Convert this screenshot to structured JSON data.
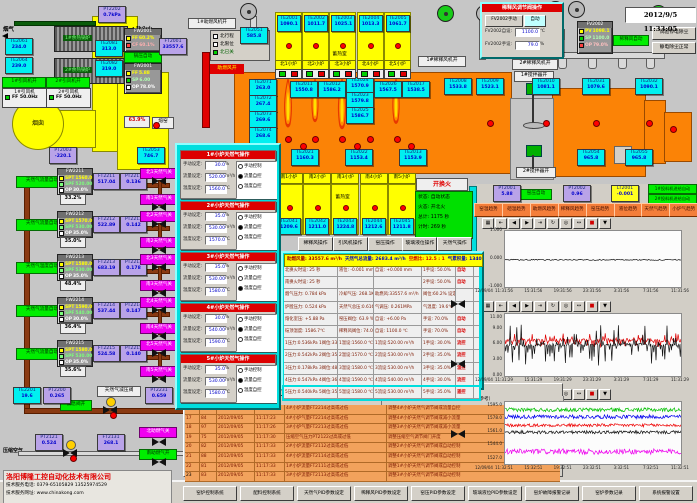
{
  "datetime": "2012/9/5 11:33:05",
  "colors": {
    "furnace_orange": "#fb8306",
    "accent_yellow": "#ffff00",
    "tag_cyan": "#00f0f0",
    "tag_lavender": "#b9a3e8",
    "status_green": "#00ee00",
    "valve_magenta": "#f000f0",
    "alarm_orange": "#f2a25c",
    "popup_cyan": "#00dede"
  },
  "top_left": {
    "flue_gas": "烟气",
    "soft_water": "软化水",
    "boilers": [
      "1#余热锅炉",
      "2#余热锅炉"
    ],
    "fan_status": [
      "1#引风机开",
      "2#引风机开"
    ],
    "fans": [
      {
        "name": "1#引风机",
        "ff": "FF 50.0Hz"
      },
      {
        "name": "2#引风机",
        "ff": "FF 50.0Hz"
      }
    ],
    "chimney": "烟囱",
    "boiler_auto": "锅压自动",
    "fw2001_top": {
      "tag": "FW2001",
      "rows": [
        [
          "FF",
          "60.2%"
        ],
        [
          "CF",
          "60.1%"
        ]
      ]
    },
    "fw2001_mid": {
      "tag": "FW2001",
      "rows": [
        [
          "FF",
          "5.88"
        ],
        [
          "SP",
          "6.00"
        ],
        [
          "OP",
          "78.0%"
        ]
      ]
    },
    "valve_pct": "63.9%",
    "kiln": "熔窑",
    "aux_air_open": "助燃风开",
    "fan1_open": "1#助燃风机开",
    "limit_box": [
      "北行程",
      "北限位",
      "北已关"
    ]
  },
  "instruments": [
    {
      "t": "PT2202",
      "v": "0.7kPa"
    },
    {
      "t": "TE2061",
      "v": "234.0"
    },
    {
      "t": "TE2064",
      "v": "239.0"
    },
    {
      "t": "TE2081",
      "v": "313.0"
    },
    {
      "t": "TE2082",
      "v": "319.0"
    },
    {
      "t": "PT2003",
      "v": "-220.1"
    },
    {
      "t": "FT2001",
      "v": "33557.6"
    },
    {
      "t": "TE2053",
      "v": "746.7"
    },
    {
      "t": "TE2051",
      "v": "585.8"
    },
    {
      "t": "TE2071",
      "v": "263.0"
    },
    {
      "t": "TE2072",
      "v": "267.4"
    },
    {
      "t": "TE2073",
      "v": "269.6"
    },
    {
      "t": "TE2074",
      "v": "268.6"
    },
    {
      "t": "TE2011",
      "v": "1550.8"
    },
    {
      "t": "TE2012",
      "v": "1586.2"
    },
    {
      "t": "TE2024",
      "v": "1570.9"
    },
    {
      "t": "TE2023",
      "v": "1579.8"
    },
    {
      "t": "TE2025",
      "v": "1586.7"
    },
    {
      "t": "TE2026",
      "v": "1567.5"
    },
    {
      "t": "TE2017",
      "v": "1538.5"
    },
    {
      "t": "TE2008",
      "v": "1533.8"
    },
    {
      "t": "TE2009",
      "v": "1523.1"
    },
    {
      "t": "TE2010",
      "v": "1081.1"
    },
    {
      "t": "TE2031",
      "v": "1079.6"
    },
    {
      "t": "TE2032",
      "v": "1090.1"
    },
    {
      "t": "TE2021",
      "v": "1160.3"
    },
    {
      "t": "TE2022",
      "v": "1153.4"
    },
    {
      "t": "TE2013",
      "v": "1153.9"
    },
    {
      "t": "TE2054",
      "v": "965.8"
    },
    {
      "t": "TE2055",
      "v": "965.8"
    },
    {
      "t": "TE2201",
      "v": "19.6"
    },
    {
      "t": "PT2200",
      "v": "0.265"
    },
    {
      "t": "PT2231",
      "v": "0.659"
    },
    {
      "t": "PT2121",
      "v": "0.524"
    },
    {
      "t": "FT2131",
      "v": "268.1"
    },
    {
      "t": "FT2002",
      "v": "6331.6"
    },
    {
      "t": "PT2001",
      "v": "5.88"
    },
    {
      "t": "PT2002",
      "v": "0.96"
    },
    {
      "t": "LT2001",
      "v": "-0.001"
    }
  ],
  "chambers_north": {
    "label": "蓄热室",
    "items": [
      {
        "tag": "TE2001",
        "val": "1090.1"
      },
      {
        "tag": "TE2002",
        "val": "1011.7"
      },
      {
        "tag": "TE2003",
        "val": "1025.1"
      },
      {
        "tag": "TE2004",
        "val": "1013.3"
      },
      {
        "tag": "TE2005",
        "val": "1061.7"
      }
    ],
    "furnaces": [
      "北1小炉",
      "北2小炉",
      "北3小炉",
      "北4小炉",
      "北5小炉"
    ]
  },
  "chambers_south": {
    "label": "蓄热室",
    "items": [
      {
        "tag": "TE2041",
        "val": "1209.6"
      },
      {
        "tag": "TE2042",
        "val": "1211.0"
      },
      {
        "tag": "TE2043",
        "val": "1224.8"
      },
      {
        "tag": "TE2044",
        "val": "1212.6"
      },
      {
        "tag": "TE2045",
        "val": "1211.8"
      }
    ],
    "furnaces": [
      "南1小炉",
      "南2小炉",
      "南3小炉",
      "南4小炉",
      "南5小炉"
    ]
  },
  "dilution_popup": {
    "title": "稀释风调节阀操作",
    "manual_btn": "FV2002手动",
    "auto_btn": "自动",
    "rows": [
      [
        "FV2002自设:",
        "1100.0",
        "℃"
      ],
      [
        "FV2002手设:",
        "79.0",
        "%"
      ]
    ]
  },
  "fv2002": {
    "tag": "FV2002",
    "rows": [
      [
        "PV",
        "1098.1"
      ],
      [
        "SP",
        "1100.0"
      ],
      [
        "OP",
        "79.0%"
      ]
    ]
  },
  "dilution_auto": "稀释风自动",
  "right_btns": [
    "试验停电除尘",
    "静电除尘正常"
  ],
  "labels_misc": {
    "valve74": "74.0%",
    "dilution_fan1": "1#稀释风机开",
    "dilution_fan2": "2#稀释风机开",
    "mixer1": "1#搅拌器开",
    "mixer2": "2#搅拌器开"
  },
  "right_tags": {
    "kiln_pressure_auto": "窑压自动",
    "feeders": [
      "1#投料机进给自动",
      "2#投料机进给自动"
    ]
  },
  "gas_lines": {
    "row_labels": [
      "SPT",
      "SPF",
      "OP"
    ],
    "auto_labels": [
      "天然气流量自动",
      "天然气流量自动",
      "天然气温度自动",
      "天然气流量自动",
      "天然气流量自动"
    ],
    "lines": [
      {
        "ctrl": "FW2211",
        "spt": "1560.0",
        "spf": "520.00",
        "op": "30.0%",
        "ft": "FT2211",
        "ftv": "517.04",
        "pt": "PT2211",
        "ptv": "0.136",
        "valve": "33.2%",
        "north": "北1天然气关",
        "south": "南1天然气关"
      },
      {
        "ctrl": "FW2212",
        "spt": "1570.0",
        "spf": "530.00",
        "op": "35.0%",
        "ft": "FT2212",
        "ftv": "522.89",
        "pt": "PT2212",
        "ptv": "0.142",
        "valve": "35.0%",
        "north": "北2天然气关",
        "south": "南2天然气关"
      },
      {
        "ctrl": "FW2213",
        "spt": "1580.0",
        "spf": "530.00",
        "op": "35.0%",
        "ft": "FT2213",
        "ftv": "683.19",
        "pt": "PT2213",
        "ptv": "0.178",
        "valve": "48.4%",
        "north": "北3天然气关",
        "south": "南3天然气关"
      },
      {
        "ctrl": "FW2214",
        "spt": "1590.0",
        "spf": "540.00",
        "op": "30.0%",
        "ft": "FT2214",
        "ftv": "537.44",
        "pt": "PT2214",
        "ptv": "0.147",
        "valve": "36.4%",
        "north": "北4天然气关",
        "south": "南4天然气关"
      },
      {
        "ctrl": "FW2215",
        "spt": "1580.0",
        "spf": "530.00",
        "op": "35.0%",
        "ft": "FT2215",
        "ftv": "524.58",
        "pt": "PT2215",
        "ptv": "0.140",
        "valve": "35.6%",
        "north": "北5天然气关",
        "south": "南5天然气关"
      }
    ]
  },
  "reduce_line": {
    "label": "天然气减压阀",
    "emergency": "紧急阀开"
  },
  "air_line": {
    "label": "压缩空气",
    "north": "北助燃气关",
    "south": "南助燃气开"
  },
  "company": {
    "name": "洛阳博隆工控自动化技术有限公司",
    "tel": "技术服务电话: 0379-65105829  13525974529",
    "web": "技术服务网址: www.chinakong.com"
  },
  "furnace_popup": {
    "field_labels": [
      "手动设定:",
      "流量设定:",
      "温度设定:"
    ],
    "units": [
      "%",
      "m³/h",
      "℃"
    ],
    "radio_labels": [
      "手动控制",
      "流量自控",
      "温度自控"
    ],
    "panels": [
      {
        "title": "1#小炉天然气操作",
        "manual": "30.0",
        "flow": "520.00",
        "temp": "1560.0",
        "mode": 1
      },
      {
        "title": "2#小炉天然气操作",
        "manual": "35.0",
        "flow": "530.00",
        "temp": "1570.0",
        "mode": 1
      },
      {
        "title": "3#小炉天然气操作",
        "manual": "35.0",
        "flow": "530.00",
        "temp": "1580.0",
        "mode": 2
      },
      {
        "title": "4#小炉天然气操作",
        "manual": "30.0",
        "flow": "540.00",
        "temp": "1590.0",
        "mode": 1
      },
      {
        "title": "5#小炉天然气操作",
        "manual": "35.0",
        "flow": "530.00",
        "temp": "1580.0",
        "mode": 1
      }
    ]
  },
  "center": {
    "change_fire_btn": "开换火",
    "status_box": [
      "状态: 自动状态",
      "火态: 开北火",
      "总计: 1175 秒",
      "计时: 269 秒"
    ],
    "ops_buttons": [
      "稀释风操作",
      "引风机操作",
      "窑压操作",
      "玻璃液位操作",
      "天然气操作"
    ],
    "summary": [
      "助燃风量: 33557.6 m³/h",
      "天然气总流量: 2683.4 m³/h",
      "空燃比: 12.5 : 1",
      "气累积量: 134057.7m³"
    ],
    "rows": [
      [
        "北换火时设: 25 秒",
        "液位: -0.001 mm",
        "自设: +0.000 mm",
        "1手设: 50.0%",
        "自动"
      ],
      [
        "南换火时设: 25 秒",
        "",
        "",
        "2手设: 50.0%",
        "自动"
      ],
      [
        "烟气压力: 0.784 kPa",
        "冷却气压: 268.1KPa",
        "助燃风:33557.6 m³/h",
        "阀位:60.2% 设定:60.0%",
        ""
      ],
      [
        "炉膛压力: 0.524 kPa",
        "天然气总压:0.616MPa",
        "气调压: 0.261MPa",
        "气温度: 19.6℃",
        ""
      ],
      [
        "熔化室压: +5.88 Pa",
        "窑压阀位: 63.9 %",
        "自设: +6.00 Pa",
        "手设: 70.0%",
        "自动"
      ],
      [
        "碹顶温度: 1586.7℃",
        "稀释风阀位: 74.0 %",
        "自设: 1100.0 ℃",
        "手设: 70.0%",
        "自动"
      ],
      [
        "1压力:0.536kPa 1阀位:33.2%",
        "1温设:1560.0 ℃",
        "1流设:520.00 m³/h",
        "1手设: 30.0%",
        "流控"
      ],
      [
        "2压力:0.542kPa 2阀位:35.0%",
        "2温设:1570.0 ℃",
        "2流设:530.00 m³/h",
        "2手设: 35.0%",
        "流控"
      ],
      [
        "3压力:0.178kPa 3阀位:48.4%",
        "3温设:1580.0 ℃",
        "3流设:530.00 m³/h",
        "3手设: 35.0%",
        "温控"
      ],
      [
        "4压力:0.547kPa 4阀位:36.4%",
        "4温设:1590.0 ℃",
        "4流设:540.00 m³/h",
        "4手设: 30.0%",
        "流控"
      ],
      [
        "5压力:0.540kPa 5阀位:35.6%",
        "5温设:1580.0 ℃",
        "5流设:530.00 m³/h",
        "5手设: 35.0%",
        "遥控"
      ]
    ]
  },
  "alarm_table": {
    "toolbar": [
      "print",
      "cols",
      "help",
      "copy",
      "filter",
      "grid",
      "sort",
      "bell",
      "save",
      "close"
    ],
    "headers": [
      "报警点",
      "报警原因（供参考）"
    ],
    "rows": [
      {
        "seq": "16",
        "code": "98",
        "date": "2012/09/05",
        "time": "11:17:21",
        "point": "4#小炉流量FT2214过高或过低",
        "reason": "调整4#小炉天然气调节阀或流量自控"
      },
      {
        "seq": "17",
        "code": "84",
        "date": "2012/09/05",
        "time": "11:17:23",
        "point": "4#小炉气量FT2214过高或过低",
        "reason": "调整4#小炉天然气调节阀或减小流量"
      },
      {
        "seq": "18",
        "code": "97",
        "date": "2012/09/05",
        "time": "11:17:26",
        "point": "3#小炉气量FT2213过高或过低",
        "reason": "调整3#小炉天然气调节阀或减小流量"
      },
      {
        "seq": "19",
        "code": "75",
        "date": "2012/09/05",
        "time": "11:17:30",
        "point": "压缩空气压力PT2122过高或过低",
        "reason": "调整压缩空气调节阀门开度"
      },
      {
        "seq": "20",
        "code": "82",
        "date": "2012/09/05",
        "time": "11:17:33",
        "point": "2#小炉流量FT2112过高或过低",
        "reason": "调整2#小炉天然气调节阀或自动控制"
      },
      {
        "seq": "21",
        "code": "88",
        "date": "2012/09/05",
        "time": "11:17:33",
        "point": "4#小炉流量FT2114过高或过低",
        "reason": "调整4#小炉天然气调节阀或自动控制"
      },
      {
        "seq": "22",
        "code": "81",
        "date": "2012/09/05",
        "time": "11:17:33",
        "point": "1#小炉流量FT2111过高或过低",
        "reason": "调整1#小炉天然气调节阀或自动控制"
      },
      {
        "seq": "23",
        "code": "83",
        "date": "2012/09/05",
        "time": "11:17:33",
        "point": "3#小炉流量FT2113过高或过低",
        "reason": "调整3#小炉天然气调节阀或自动控制"
      }
    ]
  },
  "trend_buttons": [
    "窑温趋势",
    "碹温趋势",
    "助燃风趋势",
    "稀释风趋势",
    "窑压趋势",
    "液位趋势",
    "天然气趋势",
    "小炉气趋势"
  ],
  "trend_toolbar": [
    "grid",
    "first",
    "prev",
    "next",
    "last",
    "refresh",
    "zoom",
    "pan",
    "stop",
    "save"
  ],
  "chart_data": [
    {
      "type": "line",
      "name": "玻璃液位趋势",
      "ylim": [
        -1,
        1
      ],
      "yticks": [
        "1.000",
        "0.000",
        "-1.000"
      ],
      "xticks": [
        "12/09/04",
        "11:31:56",
        "15:31:56",
        "19:31:56",
        "23:31:56",
        "3:31:56",
        "7:31:56",
        "11:31:56"
      ],
      "series": [
        {
          "name": "玻璃液位",
          "color": "#111111",
          "mean": -0.03,
          "noise": 0.02,
          "spike": 0
        }
      ]
    },
    {
      "type": "line",
      "name": "窑压趋势",
      "ylim": [
        0,
        11.8
      ],
      "yticks": [
        "11.00",
        "9.00",
        "6.00",
        "3.00",
        "0.00"
      ],
      "xticks": [
        "12/09/04",
        "11:31:29",
        "15:31:29",
        "19:31:29",
        "23:31:29",
        "3:31:29",
        "7:31:29",
        "11:31:29"
      ],
      "series": [
        {
          "name": "熔化室压",
          "color": "#dd0000",
          "mean": 6.8,
          "noise": 0.35,
          "spike": 1.2
        },
        {
          "name": "窑压",
          "color": "#111111",
          "mean": 5.9,
          "noise": 0.3,
          "spike": 3.8
        }
      ]
    },
    {
      "type": "line",
      "name": "窑温趋势",
      "ylim": [
        1520,
        1600
      ],
      "yticks": [
        "1595.0",
        "1578.0",
        "1561.0",
        "1544.0",
        "1527.0"
      ],
      "xticks": [
        "12/09/04",
        "11:32:51",
        "15:32:51",
        "19:32:51",
        "23:32:51",
        "3:32:51",
        "7:32:51",
        "11:32:51"
      ],
      "series": [
        {
          "name": "1#窑温",
          "color": "#00c000",
          "mean": 1590,
          "noise": 2.5,
          "spike": 0
        },
        {
          "name": "2#窑温",
          "color": "#0000ee",
          "mean": 1581,
          "noise": 2.5,
          "spike": 0
        },
        {
          "name": "3#窑温",
          "color": "#ee0000",
          "mean": 1570,
          "noise": 2,
          "spike": 0
        },
        {
          "name": "4#窑温",
          "color": "#111111",
          "mean": 1561,
          "noise": 2,
          "spike": 0
        },
        {
          "name": "5#窑温",
          "color": "#ee00ee",
          "mean": 1536,
          "noise": 3.5,
          "spike": 0
        }
      ]
    }
  ],
  "bottom_buttons": [
    "窑炉控制系统",
    "配料控制系统",
    "天然气PID参数设定",
    "稀释风PID参数设定",
    "窑压PID参数设定",
    "玻璃液位PID参数设定",
    "窑炉故障报警记录",
    "窑炉参数记录",
    "系统报警设置"
  ]
}
